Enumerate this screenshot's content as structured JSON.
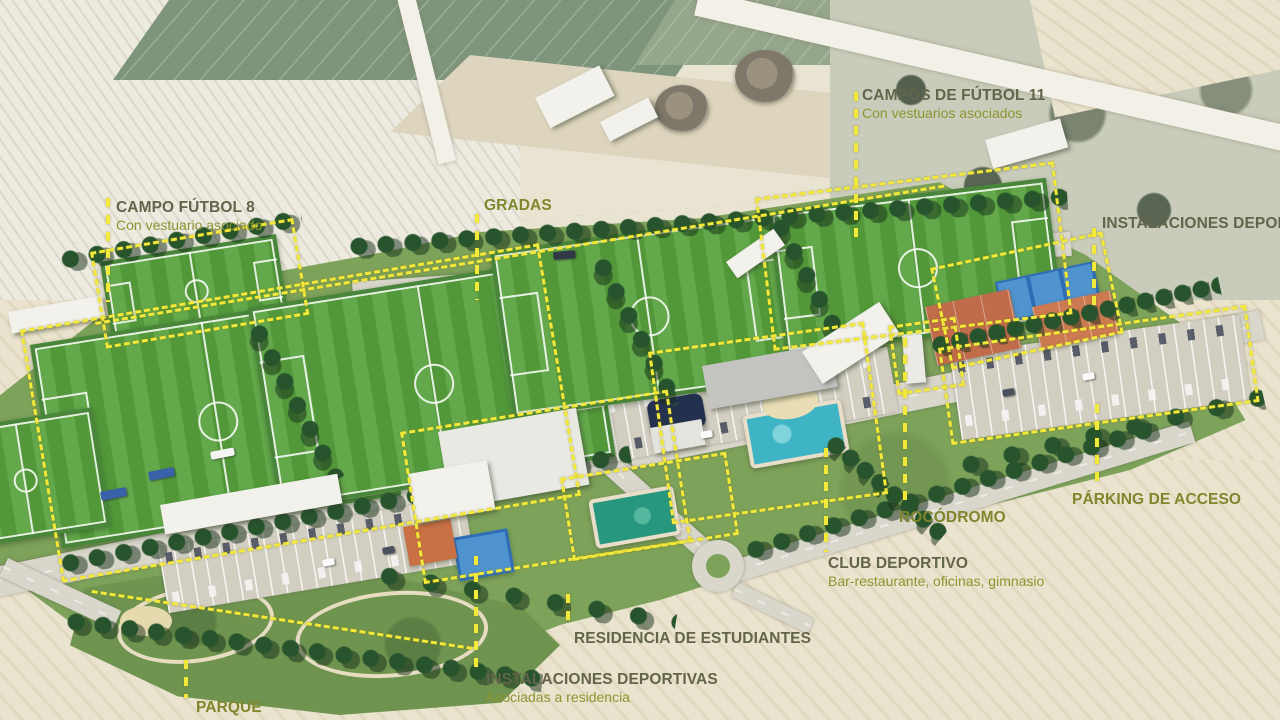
{
  "labels": [
    {
      "id": "campos-futbol-11",
      "title": "CAMPOS DE FÚTBOL 11",
      "subtitle": "Con vestuarios asociados"
    },
    {
      "id": "campo-futbol-8",
      "title": "CAMPO FÚTBOL 8",
      "subtitle": "Con vestuario asociado"
    },
    {
      "id": "gradas",
      "title": "GRADAS"
    },
    {
      "id": "instalaciones-deportivas-este",
      "title": "INSTALACIONES DEPORTIVAS"
    },
    {
      "id": "parking-de-acceso",
      "title": "PÁRKING DE ACCESO"
    },
    {
      "id": "rocodromo",
      "title": "ROCÓDROMO"
    },
    {
      "id": "club-deportivo",
      "title": "CLUB DEPORTIVO",
      "subtitle": "Bar-restaurante, oficinas, gimnasio"
    },
    {
      "id": "residencia-de-estudiantes",
      "title": "RESIDENCIA DE ESTUDIANTES"
    },
    {
      "id": "instalaciones-deportivas-residencia",
      "title": "INSTALACIONES DEPORTIVAS",
      "subtitle": "Asociadas a residencia"
    },
    {
      "id": "parque",
      "title": "PARQUE"
    }
  ],
  "colors": {
    "annotation_yellow": "#f2e93b",
    "label_dark_olive": "#62654a",
    "label_olive": "#7f862c",
    "label_sub_olive": "#8c9530",
    "pitch_green": "#57a23d",
    "site_green": "#7da25a",
    "pool_turquoise": "#3fb4c4",
    "pool_green": "#27987f",
    "clay_court_orange": "#c06b4a",
    "blue_court": "#4f93cf",
    "wheat_field": "#eae3cd"
  }
}
